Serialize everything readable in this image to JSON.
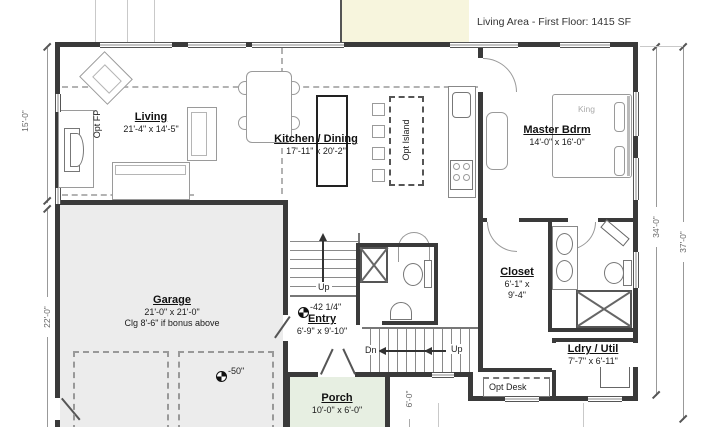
{
  "title": "Living Area - First Floor: 1415 SF",
  "rooms": {
    "living": {
      "name": "Living",
      "dims": "21'-4\" x 14'-5\""
    },
    "kitchen_dining": {
      "name": "Kitchen / Dining",
      "dims": "17'-11\" x 20'-2\""
    },
    "master_bdrm": {
      "name": "Master Bdrm",
      "dims": "14'-0\" x 16'-0\""
    },
    "garage": {
      "name": "Garage",
      "dims": "21'-0\" x 21'-0\"",
      "note": "Clg 8'-6\" if bonus above"
    },
    "entry": {
      "name": "Entry",
      "dims": "6'-9\" x 9'-10\""
    },
    "closet": {
      "name": "Closet",
      "dims_line1": "6'-1\" x",
      "dims_line2": "9'-4\""
    },
    "ldry_util": {
      "name": "Ldry / Util",
      "dims": "7'-7\" x 6'-11\""
    },
    "porch": {
      "name": "Porch",
      "dims": "10'-0\" x 6'-0\""
    }
  },
  "annotations": {
    "opt_fp": "Opt FP",
    "opt_island": "Opt Island",
    "opt_desk": "Opt Desk",
    "king": "King",
    "stairs_up": "Up",
    "stairs_dn": "Dn",
    "stairs_up2": "Up",
    "entry_elevation": "-42 1/4\"",
    "garage_elevation": "-50\""
  },
  "dimensions": {
    "left_upper": "15'-0\"",
    "left_lower": "22'-0\"",
    "right_inner": "34'-0\"",
    "right_outer": "37'-0\"",
    "porch_depth": "6'-0\""
  },
  "colors": {
    "wall": "#3a3a3a",
    "garage_fill": "#ececec",
    "porch_fill": "#e7efe2",
    "upper_floor_fill": "#f7f5dd",
    "dimension_text": "#666"
  }
}
